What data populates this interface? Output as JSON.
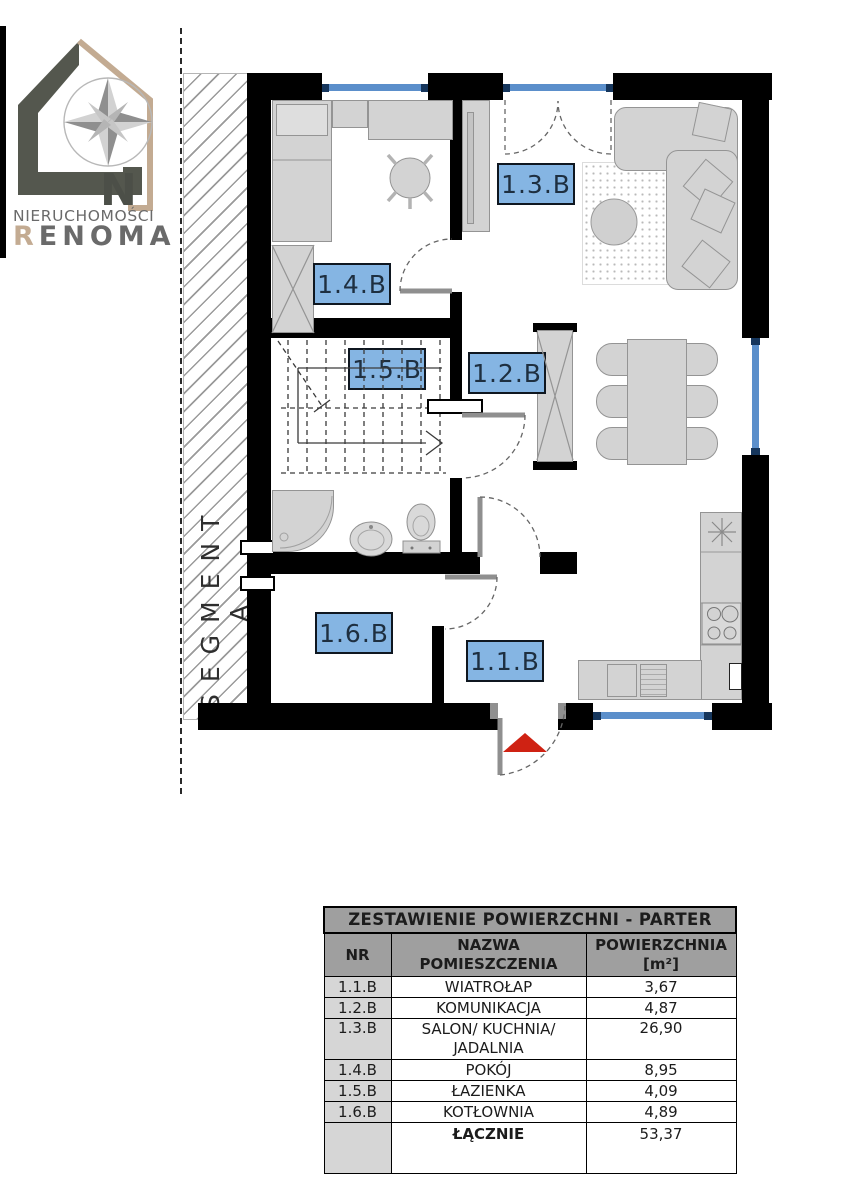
{
  "logo": {
    "line1": "NIERUCHOMOŚCI",
    "brand_first": "R",
    "brand_rest": "ENOMA",
    "compass_letter": "N"
  },
  "plan": {
    "segment_label": "SEGMENT A",
    "rooms": {
      "r11": {
        "id": "1.1.B"
      },
      "r12": {
        "id": "1.2.B"
      },
      "r13": {
        "id": "1.3.B"
      },
      "r14": {
        "id": "1.4.B"
      },
      "r15": {
        "id": "1.5.B"
      },
      "r16": {
        "id": "1.6.B"
      }
    },
    "icons": {
      "entrance_marker": "entrance-arrow",
      "compass": "compass-rose",
      "sink_symbol": "kitchen-sink-star"
    }
  },
  "colors": {
    "wall": "#000000",
    "room_label_fill": "#85b5e3",
    "room_label_border": "#0f1720",
    "window_glass": "#5b8fcb",
    "window_frame": "#16365c",
    "furniture_fill": "#d3d3d3",
    "furniture_line": "#949494",
    "entrance_arrow": "#cf2213",
    "brand_beige": "#c3ab92",
    "brand_dark": "#54574e",
    "table_header_bg": "#9f9f9f",
    "table_nr_bg": "#d6d6d6"
  },
  "table": {
    "title": "ZESTAWIENIE POWIERZCHNI - PARTER",
    "columns": [
      "NR",
      "NAZWA POMIESZCZENIA",
      "POWIERZCHNIA [m²]"
    ],
    "rows": [
      {
        "nr": "1.1.B",
        "name": "WIATROŁAP",
        "area": "3,67"
      },
      {
        "nr": "1.2.B",
        "name": "KOMUNIKACJA",
        "area": "4,87"
      },
      {
        "nr": "1.3.B",
        "name": "SALON/ KUCHNIA/\nJADALNIA",
        "area": "26,90"
      },
      {
        "nr": "1.4.B",
        "name": "POKÓJ",
        "area": "8,95"
      },
      {
        "nr": "1.5.B",
        "name": "ŁAZIENKA",
        "area": "4,09"
      },
      {
        "nr": "1.6.B",
        "name": "KOTŁOWNIA",
        "area": "4,89"
      }
    ],
    "total_row": {
      "label": "ŁĄCZNIE",
      "value": "53,37"
    }
  }
}
